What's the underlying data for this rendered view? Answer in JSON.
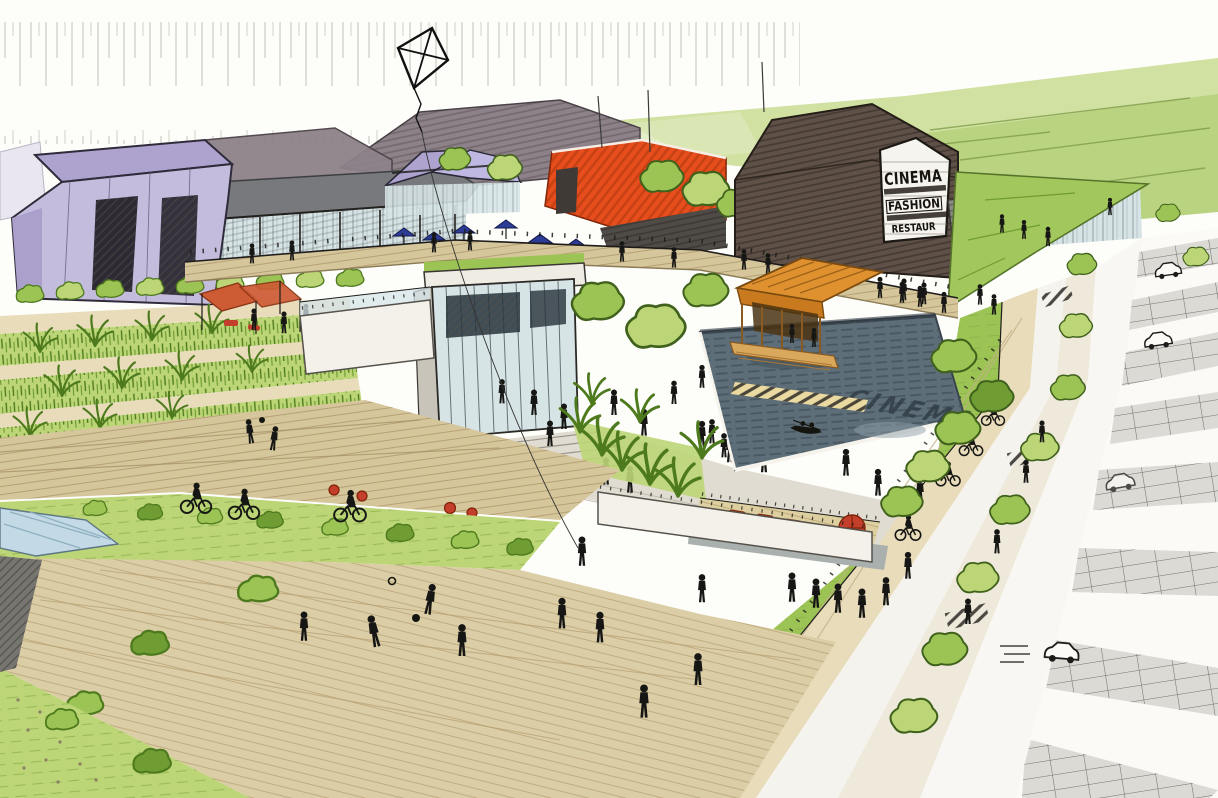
{
  "artwork": {
    "kind": "hand-drawn architectural masterplan perspective sketch",
    "signs": {
      "cinema": [
        "CINEMA",
        "FASHION",
        "RESTAUR"
      ],
      "pool_reflection": "CINEMA"
    },
    "palette": {
      "paper": "#fdfdfa",
      "ink": "#1d1c1a",
      "people": "#161614",
      "purple_wall": "#c4bcdd",
      "purple_roof": "#aea3cf",
      "mauve_roof": "#8d8289",
      "gray_roof": "#77797d",
      "glass": "#d7e4e6",
      "red_building": "#e84e1d",
      "brown_building": "#5f5148",
      "sign_white": "#f6f4ee",
      "orange_pavilion": "#e0912f",
      "pool_water": "#5d6e79",
      "veg_light": "#bcd677",
      "veg": "#9cc454",
      "veg_dark": "#6f9c33",
      "wood": "#d6c69c",
      "sand": "#e8dcba",
      "park_gray": "#dbdad5",
      "accent_red": "#c43f2b",
      "umbrella_blue": "#2d3c96",
      "canopy_red": "#cd5b33",
      "wall_white": "#f3f1ea"
    },
    "elements": [
      "kite",
      "background-trees",
      "meadow",
      "purple-warehouse",
      "glass-arcade",
      "twin-gable-pavilion",
      "mauve-gabled-hall",
      "red-warehouse",
      "cinema-building",
      "cinema-sign",
      "green-roof-building",
      "elevated-promenade",
      "glass-pavilion",
      "retaining-walls",
      "plaza-steps",
      "terraced-reed-garden",
      "play-canopy",
      "reflecting-pool",
      "pool-reflection-text",
      "timber-pavilion",
      "rowing-boat",
      "striped-gangway",
      "boardwalk",
      "lawns",
      "shrubs",
      "tall-grasses",
      "sunken-lounger-deck",
      "red-loungers",
      "red-parasol",
      "cafe-umbrellas",
      "red-poufs",
      "glass-canopy",
      "street",
      "cycle-track",
      "street-trees",
      "parking-rows",
      "cars",
      "cyclists",
      "pedestrians",
      "ball-players",
      "bench"
    ]
  }
}
